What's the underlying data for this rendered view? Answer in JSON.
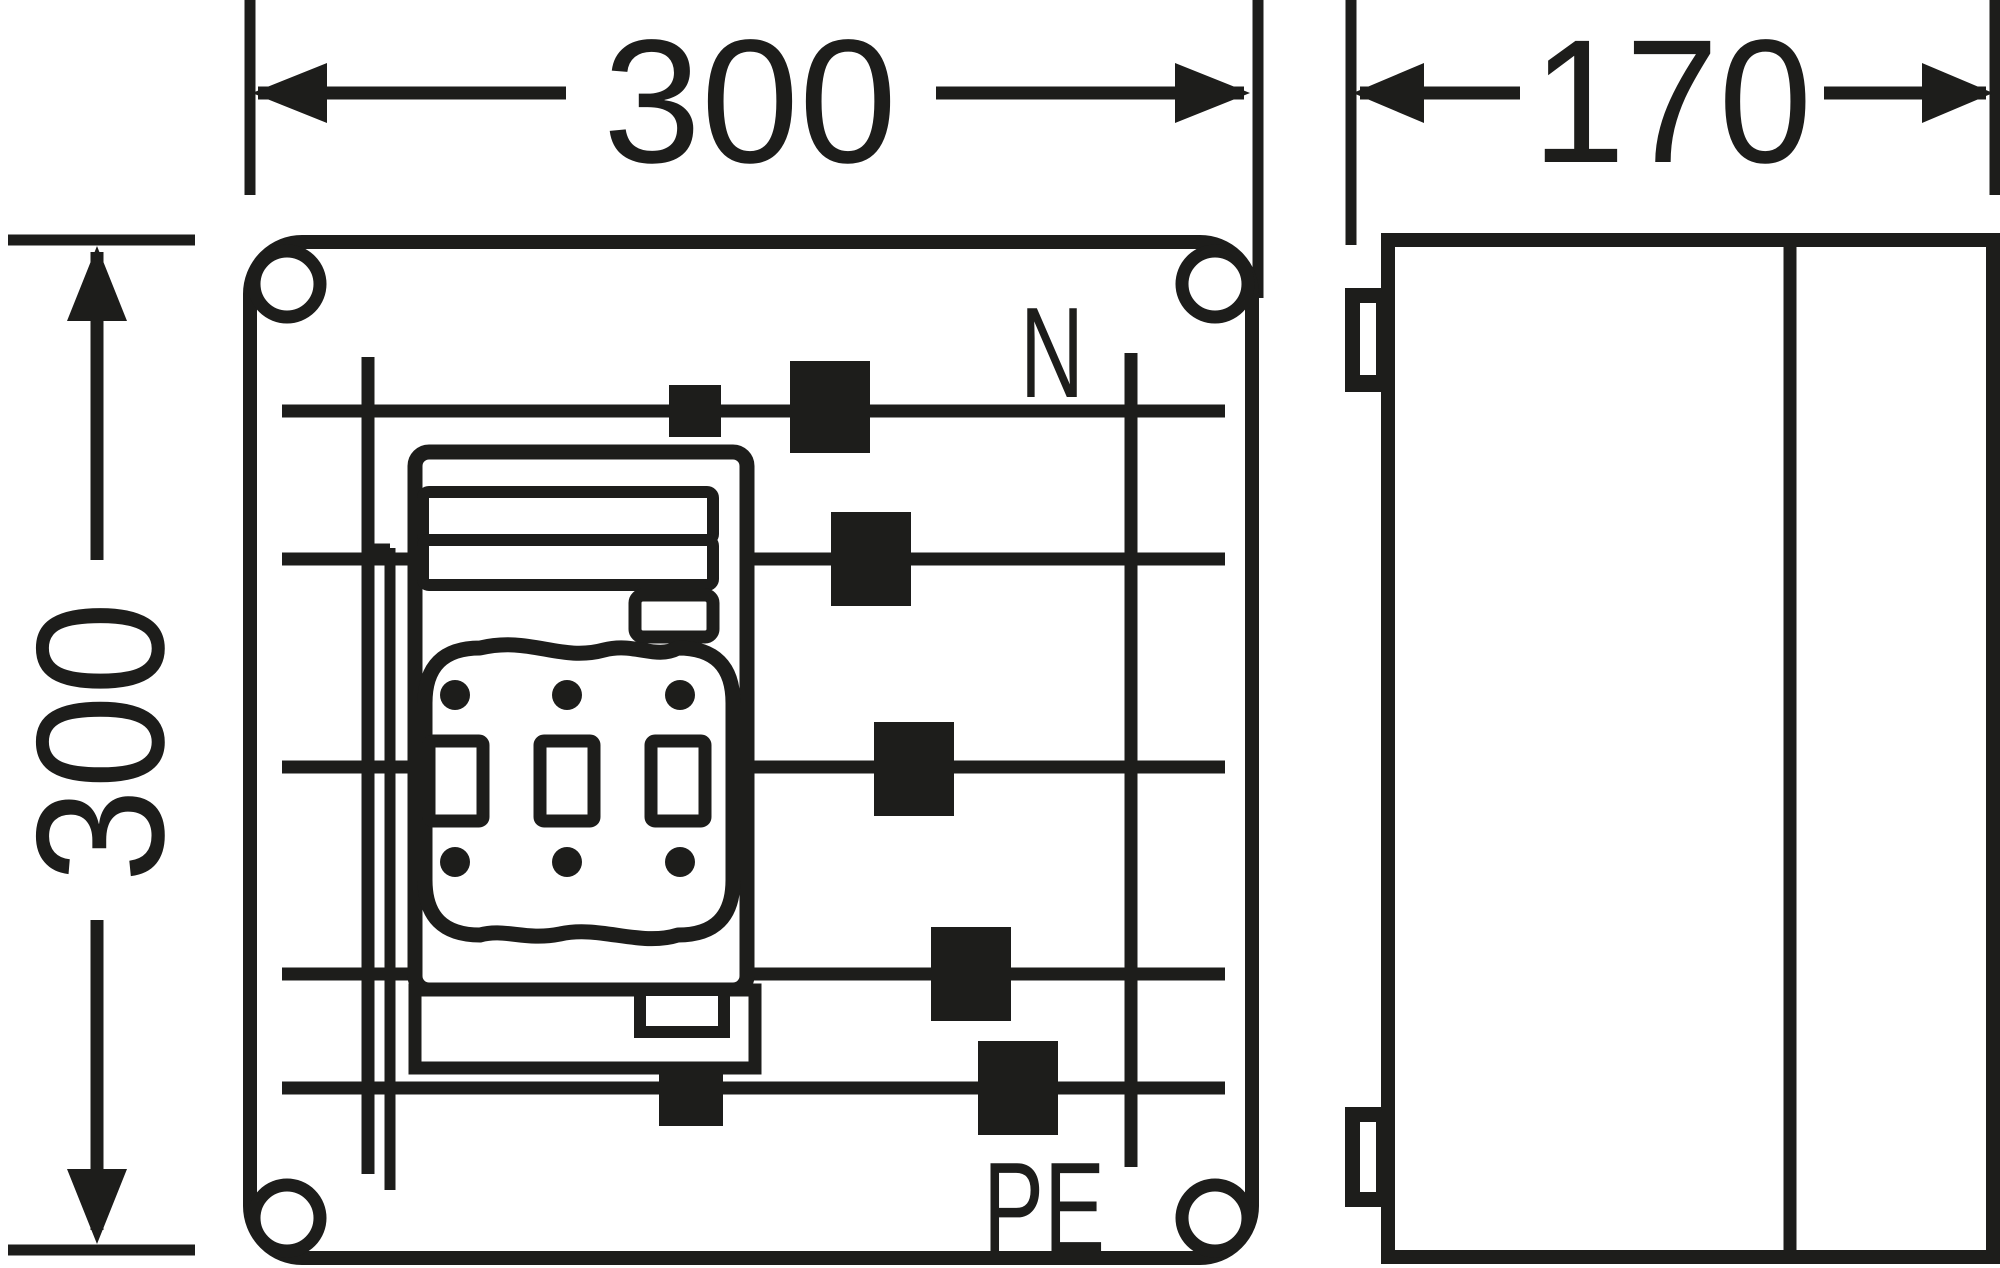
{
  "title": "Enclosure dimensional drawing",
  "colors": {
    "background": "#ffffff",
    "ink": "#1d1d1b"
  },
  "dimensions": {
    "front_width_mm": "300",
    "front_height_mm": "300",
    "side_depth_mm": "170"
  },
  "front_view": {
    "busbar_labels": {
      "neutral": "N",
      "protective_earth": "PE"
    },
    "busbar_row_count": 5,
    "corner_screw_count": 4,
    "fuse_switch": {
      "pole_count": 3,
      "contact_dot_count": 6
    },
    "terminal_square_count": 7
  },
  "side_view": {
    "wall_clip_count": 2,
    "section_count": 2
  }
}
